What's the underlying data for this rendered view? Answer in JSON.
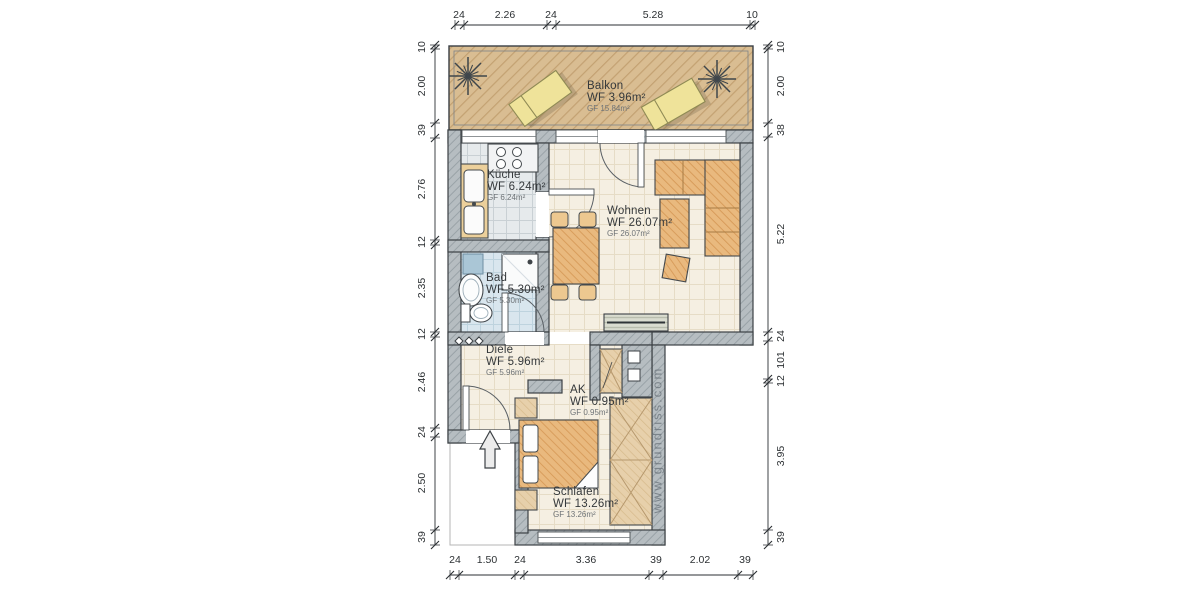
{
  "watermark": "www.grundriss.com",
  "rooms": {
    "balkon": {
      "name": "Balkon",
      "wf": "WF 3.96m²",
      "gf": "GF 15.84m²"
    },
    "kueche": {
      "name": "Küche",
      "wf": "WF 6.24m²",
      "gf": "GF 6.24m²"
    },
    "wohnen": {
      "name": "Wohnen",
      "wf": "WF 26.07m²",
      "gf": "GF 26.07m²"
    },
    "bad": {
      "name": "Bad",
      "wf": "WF 5.30m²",
      "gf": "GF 5.30m²"
    },
    "diele": {
      "name": "Diele",
      "wf": "WF 5.96m²",
      "gf": "GF 5.96m²"
    },
    "ak": {
      "name": "AK",
      "wf": "WF 0.95m²",
      "gf": "GF 0.95m²"
    },
    "schlafen": {
      "name": "Schlafen",
      "wf": "WF 13.26m²",
      "gf": "GF 13.26m²"
    }
  },
  "dimensions": {
    "top": [
      "24",
      "2.26",
      "24",
      "5.28",
      "10"
    ],
    "left": [
      "10",
      "2.00",
      "39",
      "2.76",
      "12",
      "2.35",
      "12",
      "2.46",
      "24",
      "2.50",
      "39"
    ],
    "right": [
      "10",
      "2.00",
      "38",
      "5.22",
      "24",
      "101",
      "12",
      "3.95",
      "39"
    ],
    "bottom": [
      "24",
      "1.50",
      "24",
      "3.36",
      "39",
      "2.02",
      "39"
    ]
  },
  "colors": {
    "wall": "#b6bdc1",
    "wall_hatch": "#99a2a7",
    "balcony_floor": "#d9bd92",
    "wood_furniture": "#e9b97e",
    "cabinet": "#e7d0ab",
    "kitchen_tile": "#e6eaec",
    "bath_tile": "#d9e6ee",
    "living_floor": "#f5efe2",
    "lounger": "#efe39a",
    "outline": "#3c4145",
    "dimension_text": "#2c3033"
  }
}
